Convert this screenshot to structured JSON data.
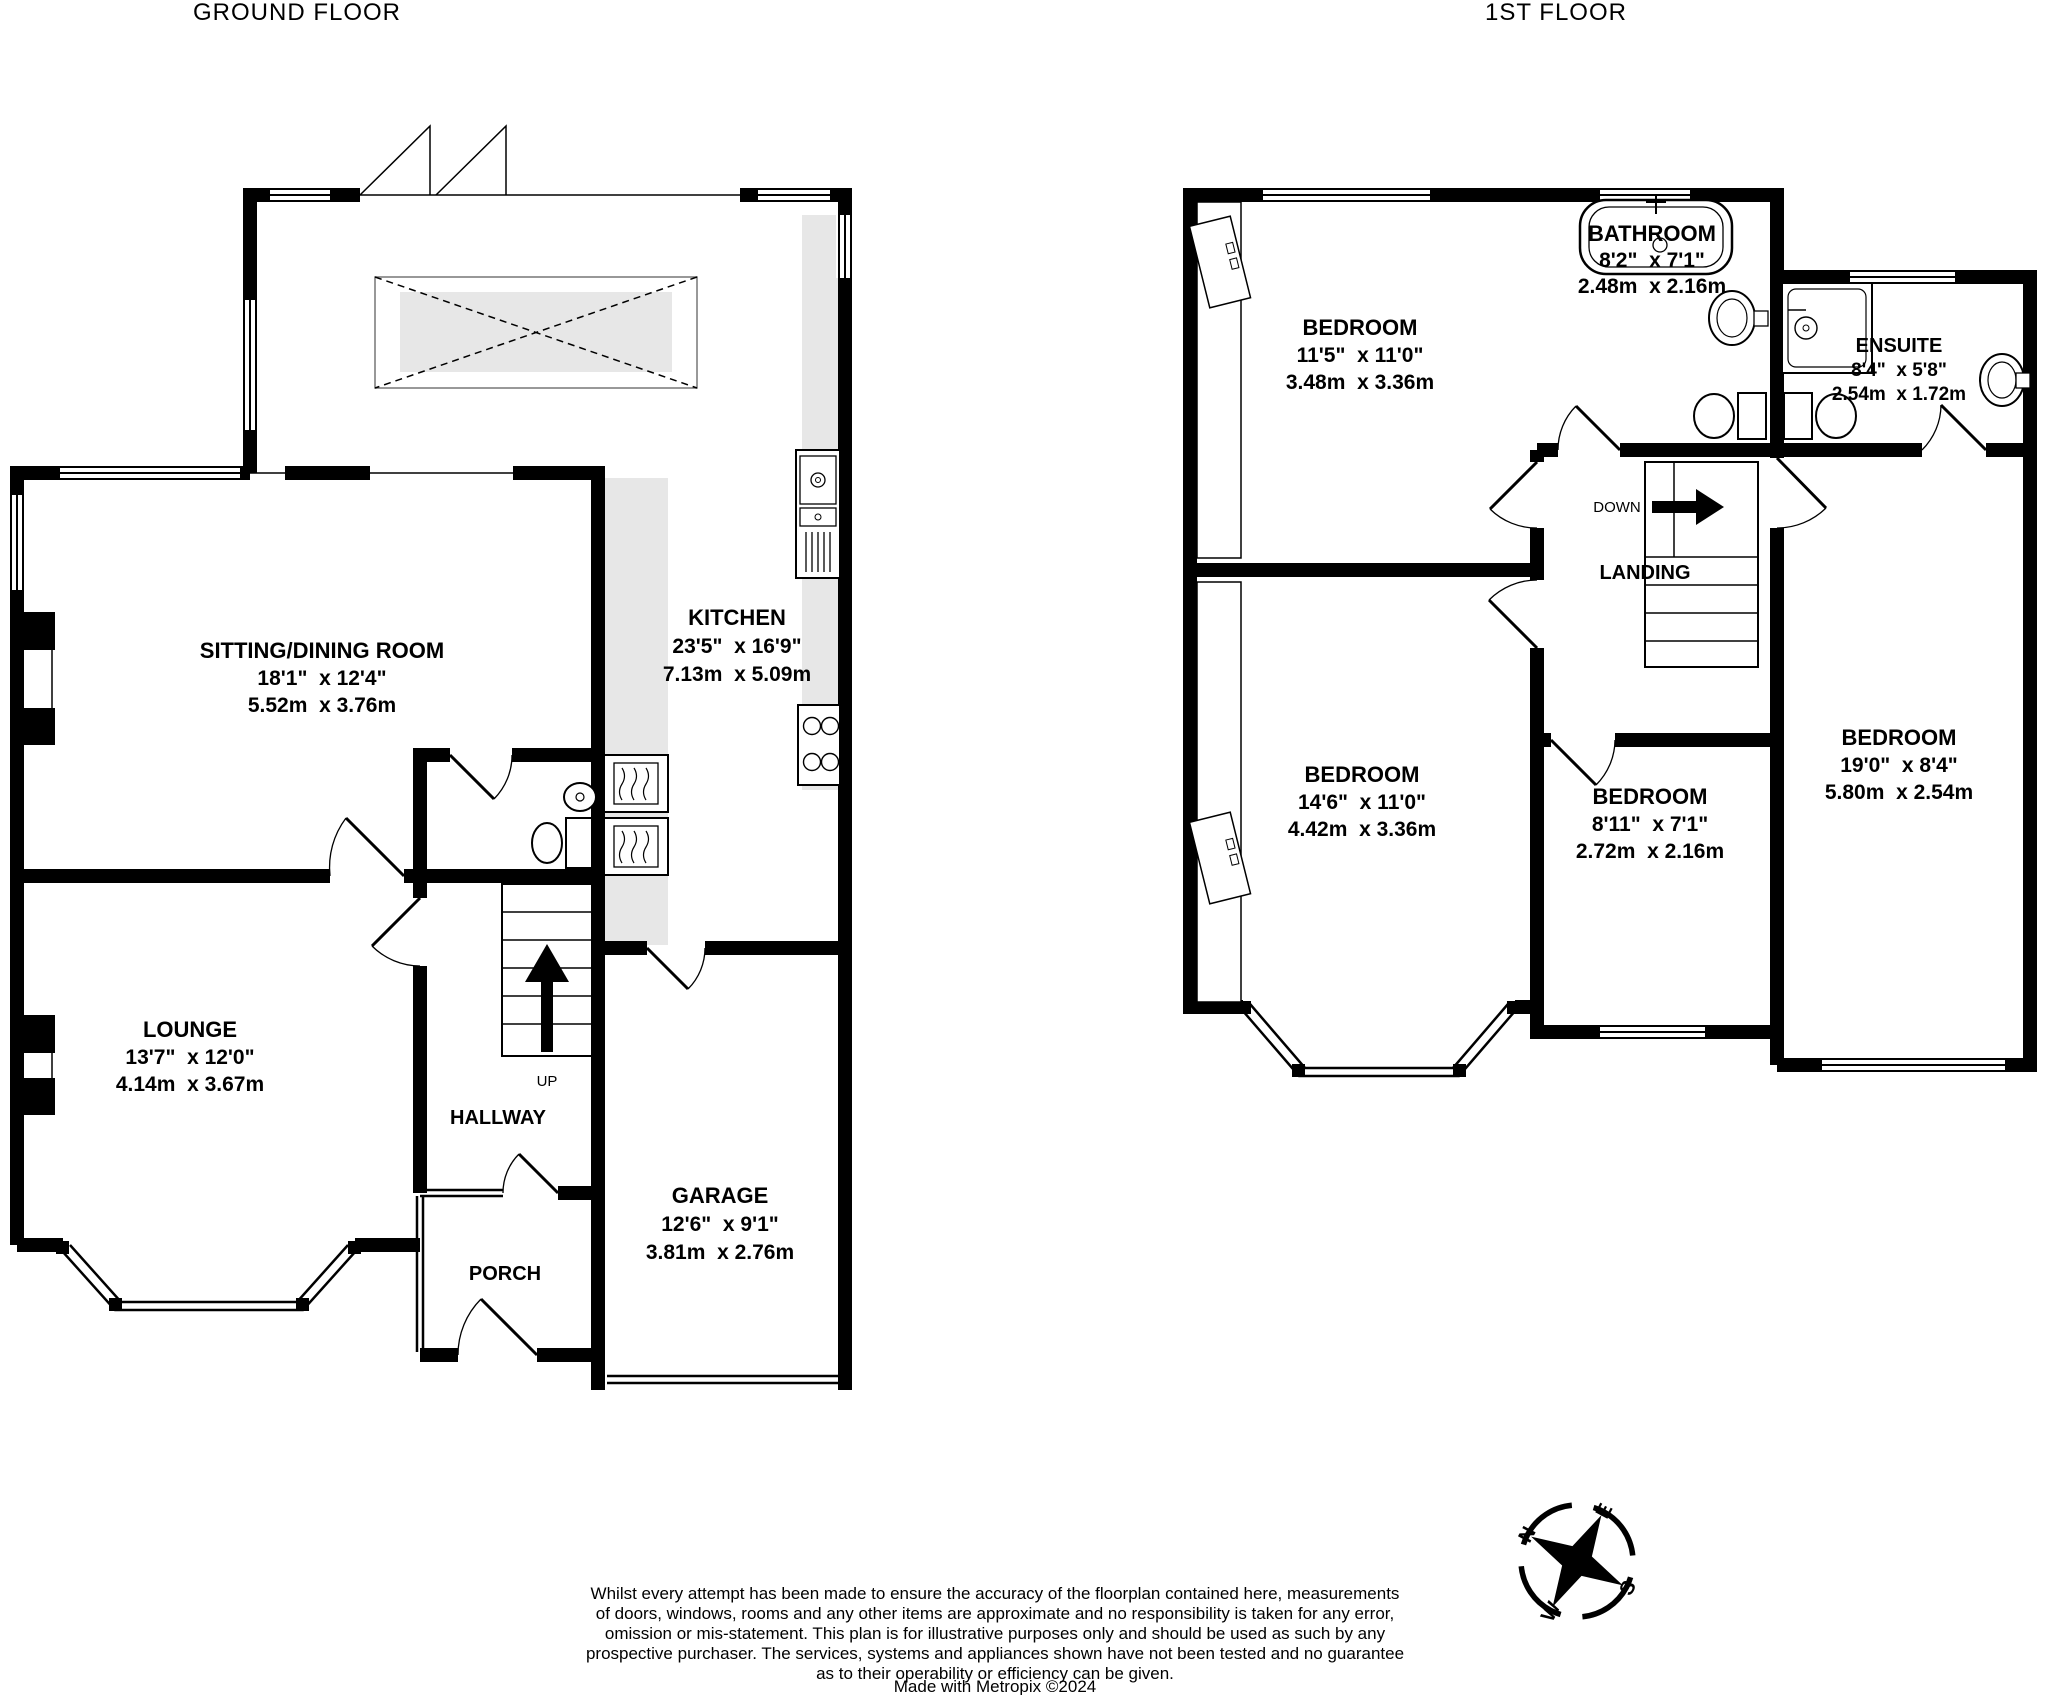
{
  "ground_floor": {
    "title": "GROUND FLOOR",
    "stairs_label": "UP",
    "rooms": {
      "sitting_dining": {
        "name": "SITTING/DINING ROOM",
        "size_imperial": "18'1\"  x 12'4\"",
        "size_metric": "5.52m  x 3.76m"
      },
      "kitchen": {
        "name": "KITCHEN",
        "size_imperial": "23'5\"  x 16'9\"",
        "size_metric": "7.13m  x 5.09m"
      },
      "lounge": {
        "name": "LOUNGE",
        "size_imperial": "13'7\"  x 12'0\"",
        "size_metric": "4.14m  x 3.67m"
      },
      "garage": {
        "name": "GARAGE",
        "size_imperial": "12'6\"  x 9'1\"",
        "size_metric": "3.81m  x 2.76m"
      },
      "hallway": {
        "name": "HALLWAY"
      },
      "porch": {
        "name": "PORCH"
      }
    }
  },
  "first_floor": {
    "title": "1ST FLOOR",
    "stairs_label": "DOWN",
    "rooms": {
      "bedroom_front": {
        "name": "BEDROOM",
        "size_imperial": "11'5\"  x 11'0\"",
        "size_metric": "3.48m  x 3.36m"
      },
      "bathroom": {
        "name": "BATHROOM",
        "size_imperial": "8'2\"  x 7'1\"",
        "size_metric": "2.48m  x 2.16m"
      },
      "ensuite": {
        "name": "ENSUITE",
        "size_imperial": "8'4\"  x 5'8\"",
        "size_metric": "2.54m  x 1.72m"
      },
      "bedroom_rear": {
        "name": "BEDROOM",
        "size_imperial": "14'6\"  x 11'0\"",
        "size_metric": "4.42m  x 3.36m"
      },
      "bedroom_small": {
        "name": "BEDROOM",
        "size_imperial": "8'11\"  x 7'1\"",
        "size_metric": "2.72m  x 2.16m"
      },
      "bedroom_long": {
        "name": "BEDROOM",
        "size_imperial": "19'0\"  x 8'4\"",
        "size_metric": "5.80m  x 2.54m"
      },
      "landing": {
        "name": "LANDING"
      }
    }
  },
  "compass": {
    "north": "N",
    "east": "E",
    "south": "S",
    "west": "W"
  },
  "footer": {
    "disclaimer_lines": [
      "Whilst every attempt has been made to ensure the accuracy of the floorplan contained here, measurements",
      "of doors, windows, rooms and any other items are approximate and no responsibility is taken for any error,",
      "omission or mis-statement. This plan is for illustrative purposes only and should be used as such by any",
      "prospective purchaser. The services, systems and appliances shown have not been tested and no guarantee",
      "as to their operability or efficiency can be given."
    ],
    "credit": "Made with Metropix ©2024"
  }
}
